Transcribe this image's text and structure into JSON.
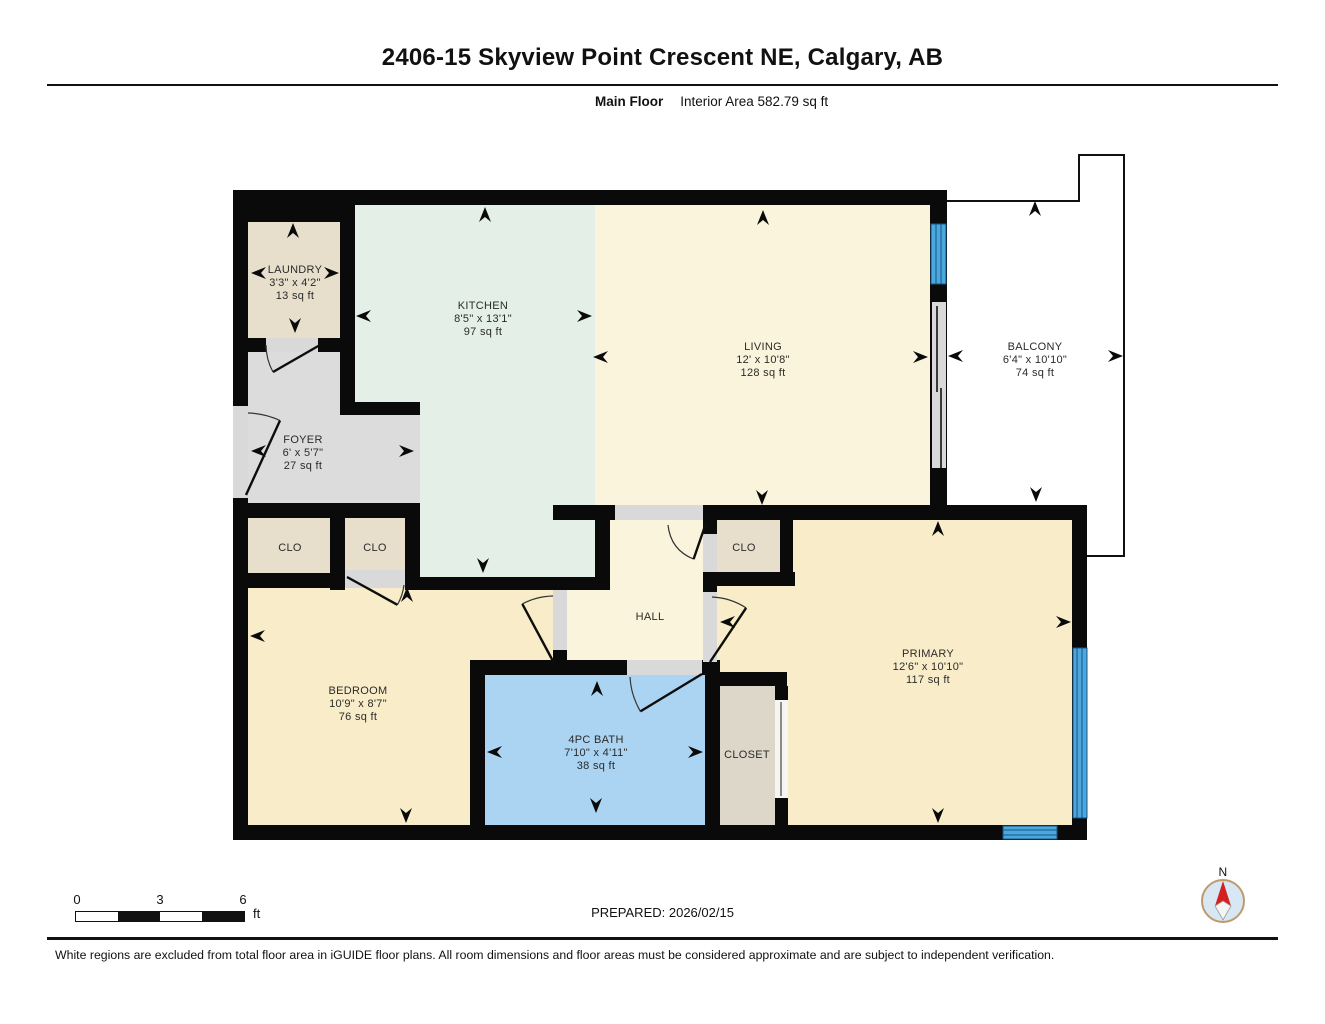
{
  "header": {
    "title": "2406-15 Skyview Point Crescent NE, Calgary, AB",
    "floor_label": "Main Floor",
    "interior_area": "Interior Area 582.79 sq ft"
  },
  "rooms": {
    "laundry": {
      "name": "LAUNDRY",
      "dims": "3'3\" x 4'2\"",
      "area": "13 sq ft"
    },
    "kitchen": {
      "name": "KITCHEN",
      "dims": "8'5\" x 13'1\"",
      "area": "97 sq ft"
    },
    "living": {
      "name": "LIVING",
      "dims": "12' x 10'8\"",
      "area": "128 sq ft"
    },
    "balcony": {
      "name": "BALCONY",
      "dims": "6'4\" x 10'10\"",
      "area": "74 sq ft"
    },
    "foyer": {
      "name": "FOYER",
      "dims": "6' x 5'7\"",
      "area": "27 sq ft"
    },
    "closet1": {
      "name": "CLO"
    },
    "closet2": {
      "name": "CLO"
    },
    "closet3": {
      "name": "CLO"
    },
    "hall": {
      "name": "HALL"
    },
    "bedroom": {
      "name": "BEDROOM",
      "dims": "10'9\" x 8'7\"",
      "area": "76 sq ft"
    },
    "bath": {
      "name": "4PC BATH",
      "dims": "7'10\" x 4'11\"",
      "area": "38 sq ft"
    },
    "closet": {
      "name": "CLOSET"
    },
    "primary": {
      "name": "PRIMARY",
      "dims": "12'6\" x 10'10\"",
      "area": "117 sq ft"
    }
  },
  "footer": {
    "scale": {
      "t0": "0",
      "t3": "3",
      "t6": "6",
      "unit": "ft"
    },
    "prepared": "PREPARED: 2026/02/15",
    "compass": "N"
  },
  "disclaimer": "White regions are excluded from total floor area in iGUIDE floor plans. All room dimensions and floor areas must be considered approximate and are subject to independent verification.",
  "colors": {
    "wall": "#0a0a0a",
    "beige": "#e7dfcc",
    "closet_tan": "#ddd7c9",
    "kitchen_green": "#e4efe8",
    "cream": "#fbf4dc",
    "wheat": "#f8edc8",
    "foyer_gray": "#dcdcdc",
    "opening_gray": "#d9d9d9",
    "bath_blue": "#abd3f2",
    "window_blue": "#4aa8de",
    "window_frame": "#1a5482",
    "compass_fill": "#d7e7f4",
    "compass_ring": "#bf9a6b",
    "compass_north": "#d42020"
  }
}
